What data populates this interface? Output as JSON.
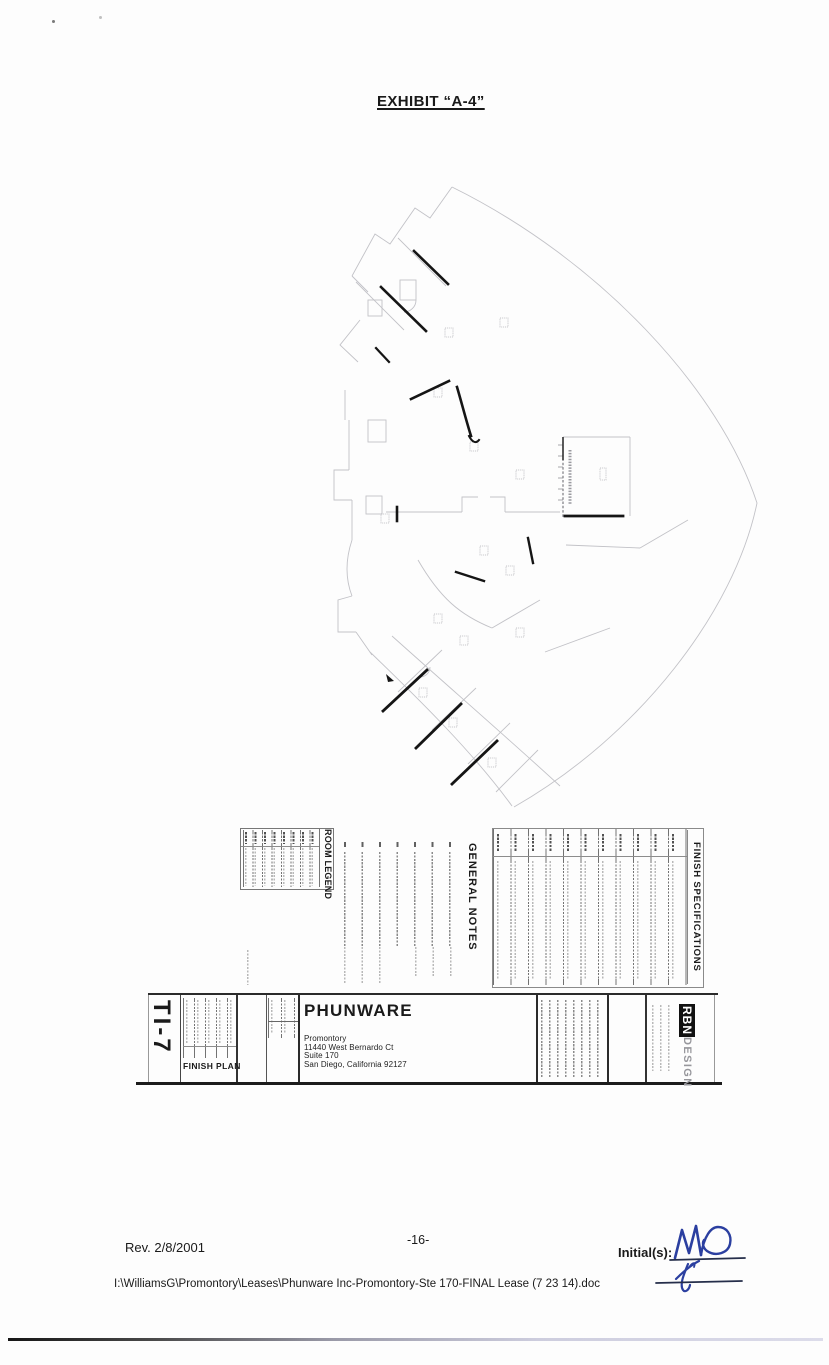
{
  "header": {
    "title": "EXHIBIT “A-4”"
  },
  "legend": {
    "room_legend_title": "ROOM LEGEND",
    "general_notes_title": "GENERAL NOTES",
    "finish_specifications_title": "FINISH SPECIFICATIONS"
  },
  "titleblock": {
    "sheet_number": "TI-7",
    "sheet_name": "FINISH PLAN",
    "client_name": "PHUNWARE",
    "address": [
      "Promontory",
      "11440 West Bernardo Ct",
      "Suite 170",
      "San Diego, California 92127"
    ],
    "firm_name_primary": "RBN",
    "firm_name_secondary": "DESIGN"
  },
  "footer": {
    "revision": "Rev. 2/8/2001",
    "page_number": "-16-",
    "initials_label": "Initial(s):",
    "document_path": "I:\\WilliamsG\\Promontory\\Leases\\Phunware Inc-Promontory-Ste 170-FINAL Lease (7 23 14).doc"
  }
}
